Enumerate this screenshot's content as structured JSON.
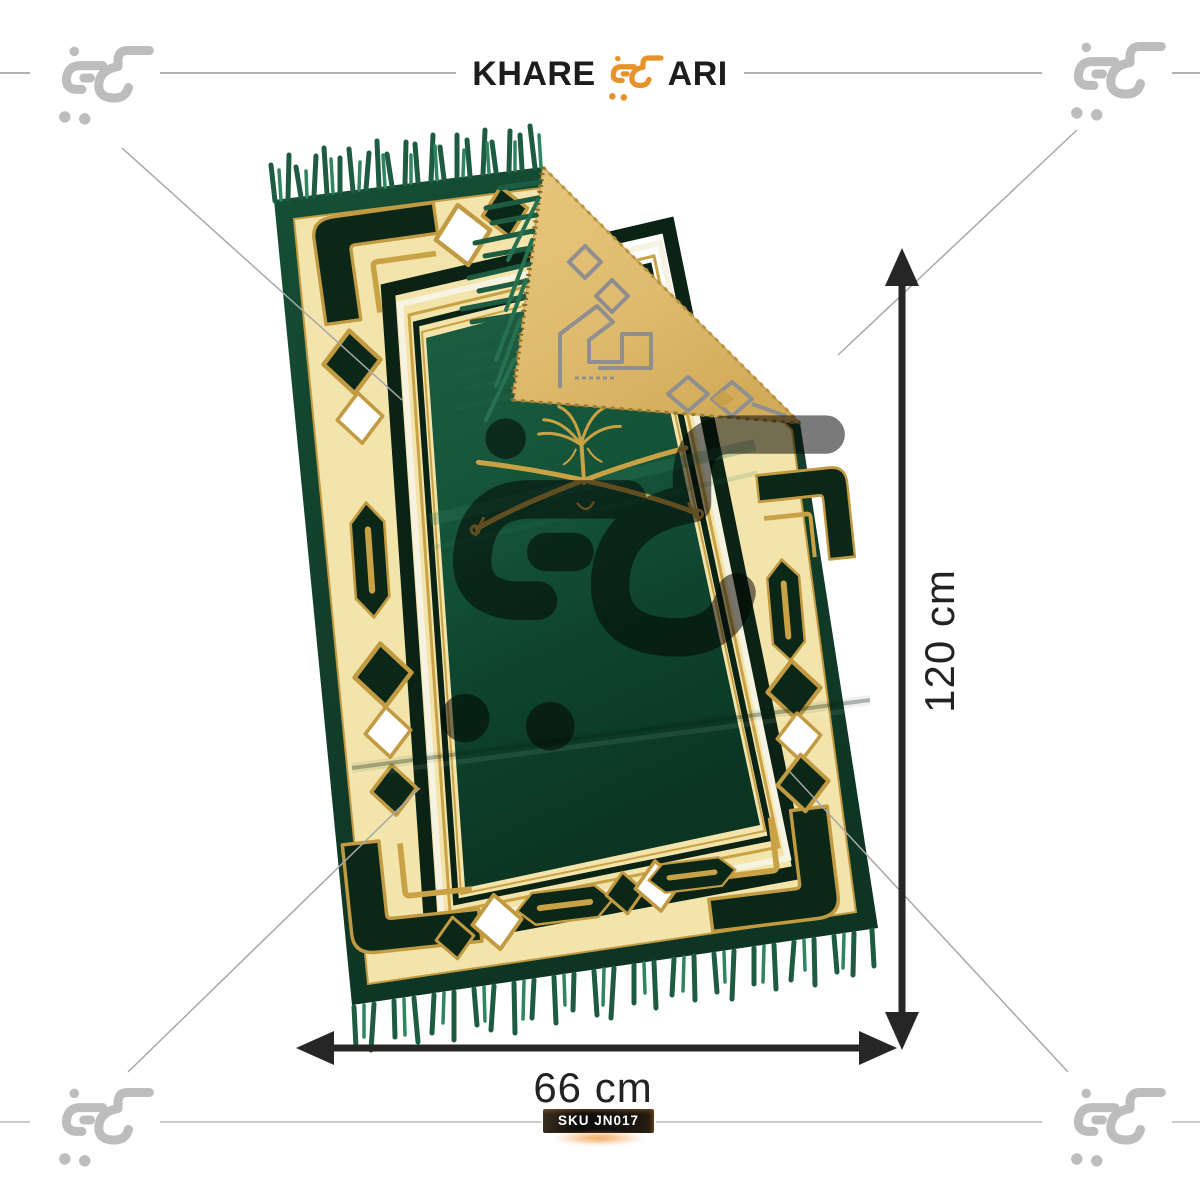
{
  "page": {
    "bg": "#ffffff",
    "top_rule_color": "#999999",
    "bottom_rule_color": "#cccccc"
  },
  "header": {
    "wordmark_left": "KHARE",
    "wordmark_right": "ARI",
    "cart_icon": "khareedari-cart",
    "cart_icon_color": "#E8922A",
    "text_color": "#1c1c1c"
  },
  "watermarks": {
    "corner_icon": "khareedari-cart",
    "corner_color": "#bdbdbd",
    "center_color": "#6f6f6f",
    "guide_line_color": "#a8a8a8"
  },
  "product": {
    "name": "Green velvet prayer mat with cream-and-gold geometric border, Saudi palm-and-swords emblem, fringed edges, top-right corner folded over showing golden woven back",
    "colors": {
      "fringe": "#2a7a57",
      "margin_green": "#123f2b",
      "motif_dark": "#0b2718",
      "border_cream": "#f3e4ab",
      "gold_outline": "#c19a42",
      "field_light": "#1d5f42",
      "field_dark": "#0a3522",
      "fold_back_gold": "#debb6e",
      "fold_pattern_gray": "#8f8f8f",
      "emblem_gold": "#c9a245"
    }
  },
  "dimensions": {
    "height_label": "120 cm",
    "width_label": "66 cm",
    "arrow_color": "#262626",
    "label_color": "#222222"
  },
  "sku": {
    "label": "SKU JN017",
    "bg": "#121212",
    "text_color": "#ffffff",
    "glow": "#E8862A"
  }
}
